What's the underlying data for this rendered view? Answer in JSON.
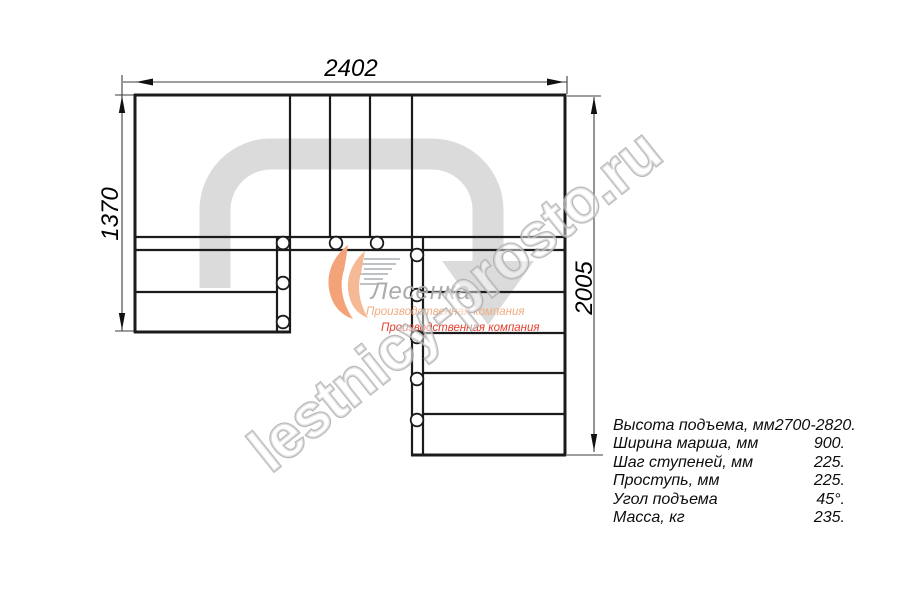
{
  "drawing_title": "U-shaped staircase plan (top view)",
  "dimensions": {
    "top": "2402",
    "left": "1370",
    "right": "2005"
  },
  "watermark": {
    "text": "lestnicy-prosto.ru"
  },
  "logo": {
    "name": "Лесенка",
    "tagline1": "Производственная компания",
    "tagline2": "Производственная компания"
  },
  "specs": {
    "rows": [
      {
        "label": "Высота подъема, мм",
        "value": "2700-2820."
      },
      {
        "label": "Ширина марша, мм",
        "value": "900."
      },
      {
        "label": "Шаг ступеней, мм",
        "value": "225."
      },
      {
        "label": "Проступь, мм",
        "value": "225."
      },
      {
        "label": "Угол подъема",
        "value": "45°."
      },
      {
        "label": "Масса, кг",
        "value": "235."
      }
    ]
  },
  "colors": {
    "line": "#1b1b1b",
    "path_arrow": "#dbdbdb",
    "watermark_outline": "#ababab",
    "logo_orange": "#f4a379",
    "logo_orange_light": "#f6b590",
    "tagline_tan": "#f0ac83",
    "tagline_red": "#e2402f",
    "background": "#ffffff"
  }
}
